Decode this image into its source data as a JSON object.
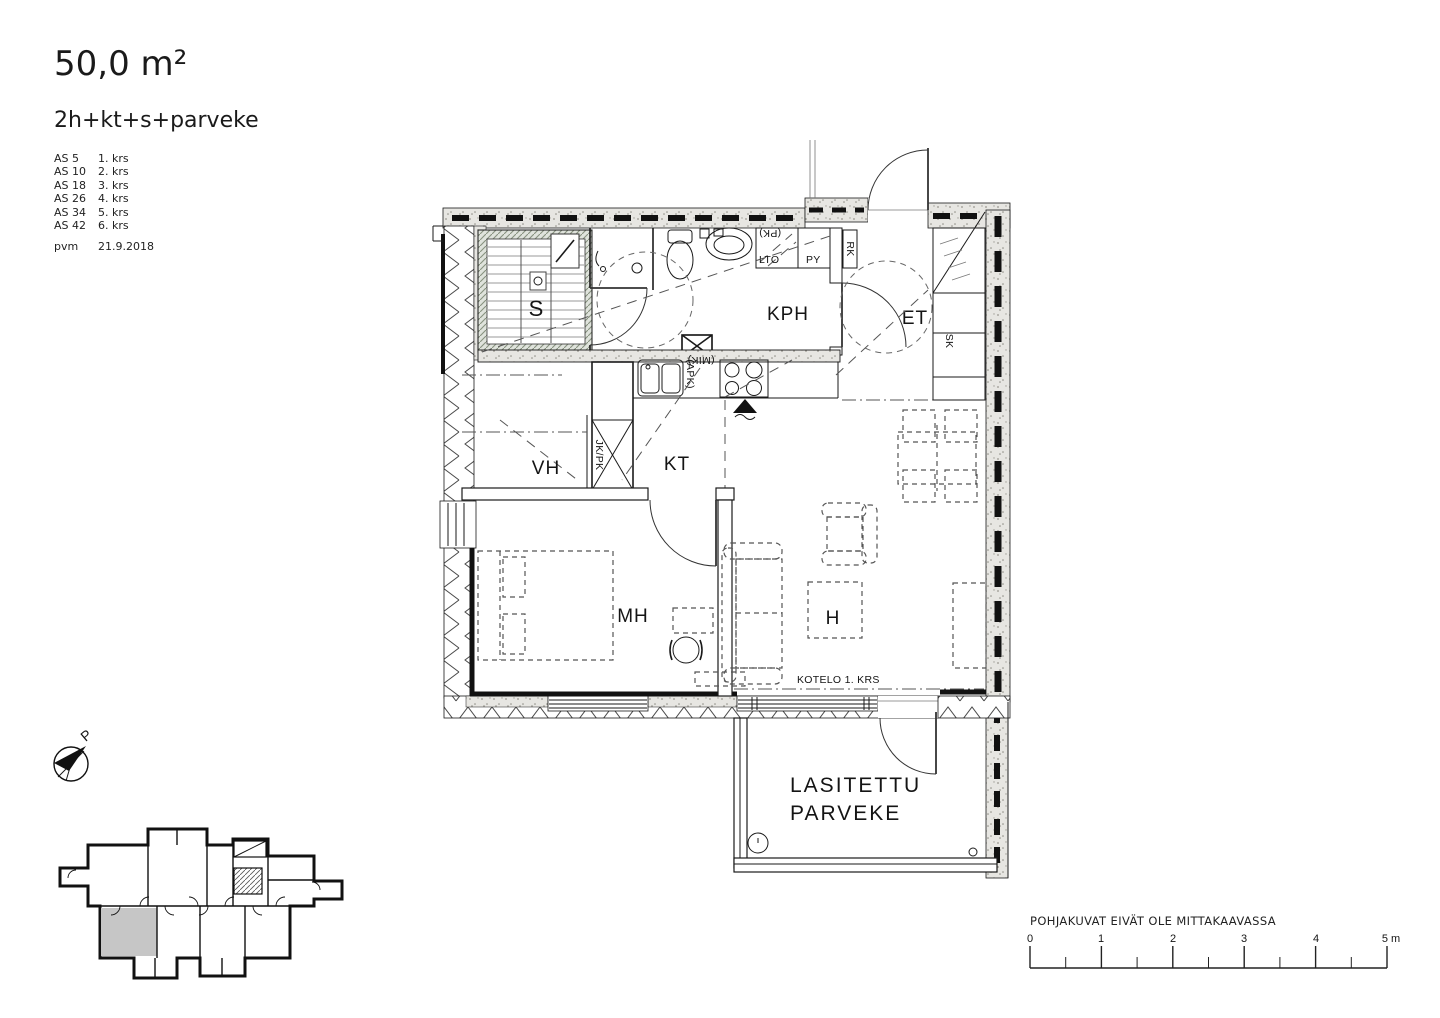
{
  "header": {
    "area": "50,0 m²",
    "layout_type": "2h+kt+s+parveke",
    "units": [
      {
        "apartment": "AS 5",
        "floor": "1. krs"
      },
      {
        "apartment": "AS 10",
        "floor": "2. krs"
      },
      {
        "apartment": "AS 18",
        "floor": "3. krs"
      },
      {
        "apartment": "AS 26",
        "floor": "4. krs"
      },
      {
        "apartment": "AS 34",
        "floor": "5. krs"
      },
      {
        "apartment": "AS 42",
        "floor": "6. krs"
      }
    ],
    "date_label": "pvm",
    "date_value": "21.9.2018"
  },
  "plan": {
    "room_labels": {
      "sauna": "S",
      "bathroom": "KPH",
      "entry": "ET",
      "walk_in_closet": "VH",
      "kitchen": "KT",
      "bedroom": "MH",
      "living_room": "H"
    },
    "balcony_label_line1": "LASITETTU",
    "balcony_label_line2": "PARVEKE",
    "duct_note": "KOTELO 1. KRS",
    "fixture_labels": {
      "heat_recovery": "LTO",
      "washer_reservation": "(PK)",
      "dryer": "PY",
      "electrical_cabinet": "RK",
      "closet": "SK",
      "fridge_freezer": "JK/PK",
      "dishwasher_reservation": "(APK)",
      "microwave_reservation": "(MIK)"
    }
  },
  "compass": {
    "north_label": "P"
  },
  "footer": {
    "disclaimer": "POHJAKUVAT EIVÄT OLE MITTAKAAVASSA",
    "scale_unit_ticks": [
      "0",
      "1",
      "2",
      "3",
      "4",
      "5 m"
    ]
  }
}
